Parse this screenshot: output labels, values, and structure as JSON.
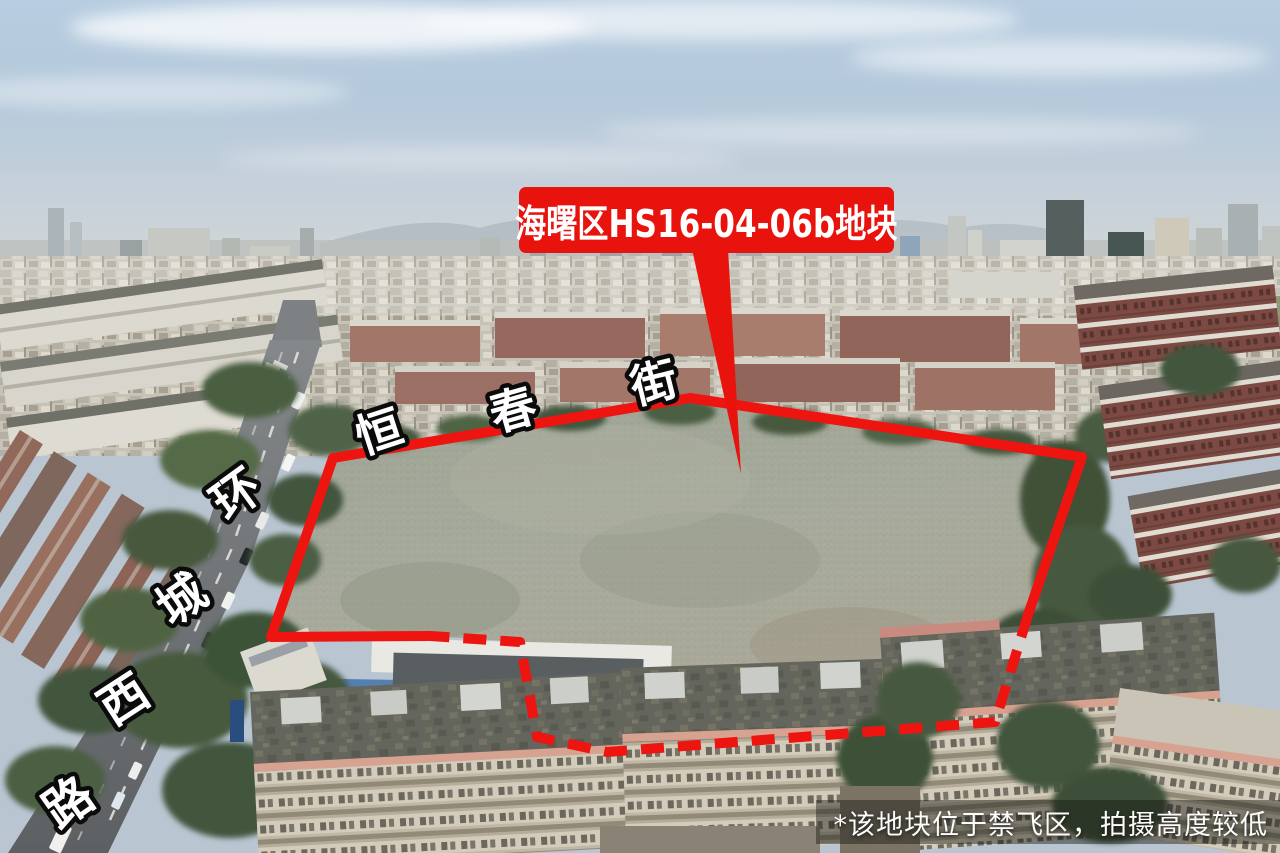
{
  "annotation": {
    "plot_label": "海曙区HS16-04-06b地块",
    "note": "*该地块位于禁飞区，拍摄高度较低",
    "colors": {
      "callout_red": "#e9130d",
      "boundary_red": "#ee1410",
      "label_text": "#ffffff",
      "note_text": "#fdfdfb"
    }
  },
  "streets": {
    "hengchun": {
      "name": "恒春街",
      "chars": [
        "恒",
        "春",
        "街"
      ]
    },
    "huancheng_west": {
      "name": "环城西路",
      "chars": [
        "环",
        "城",
        "西",
        "路"
      ]
    }
  }
}
